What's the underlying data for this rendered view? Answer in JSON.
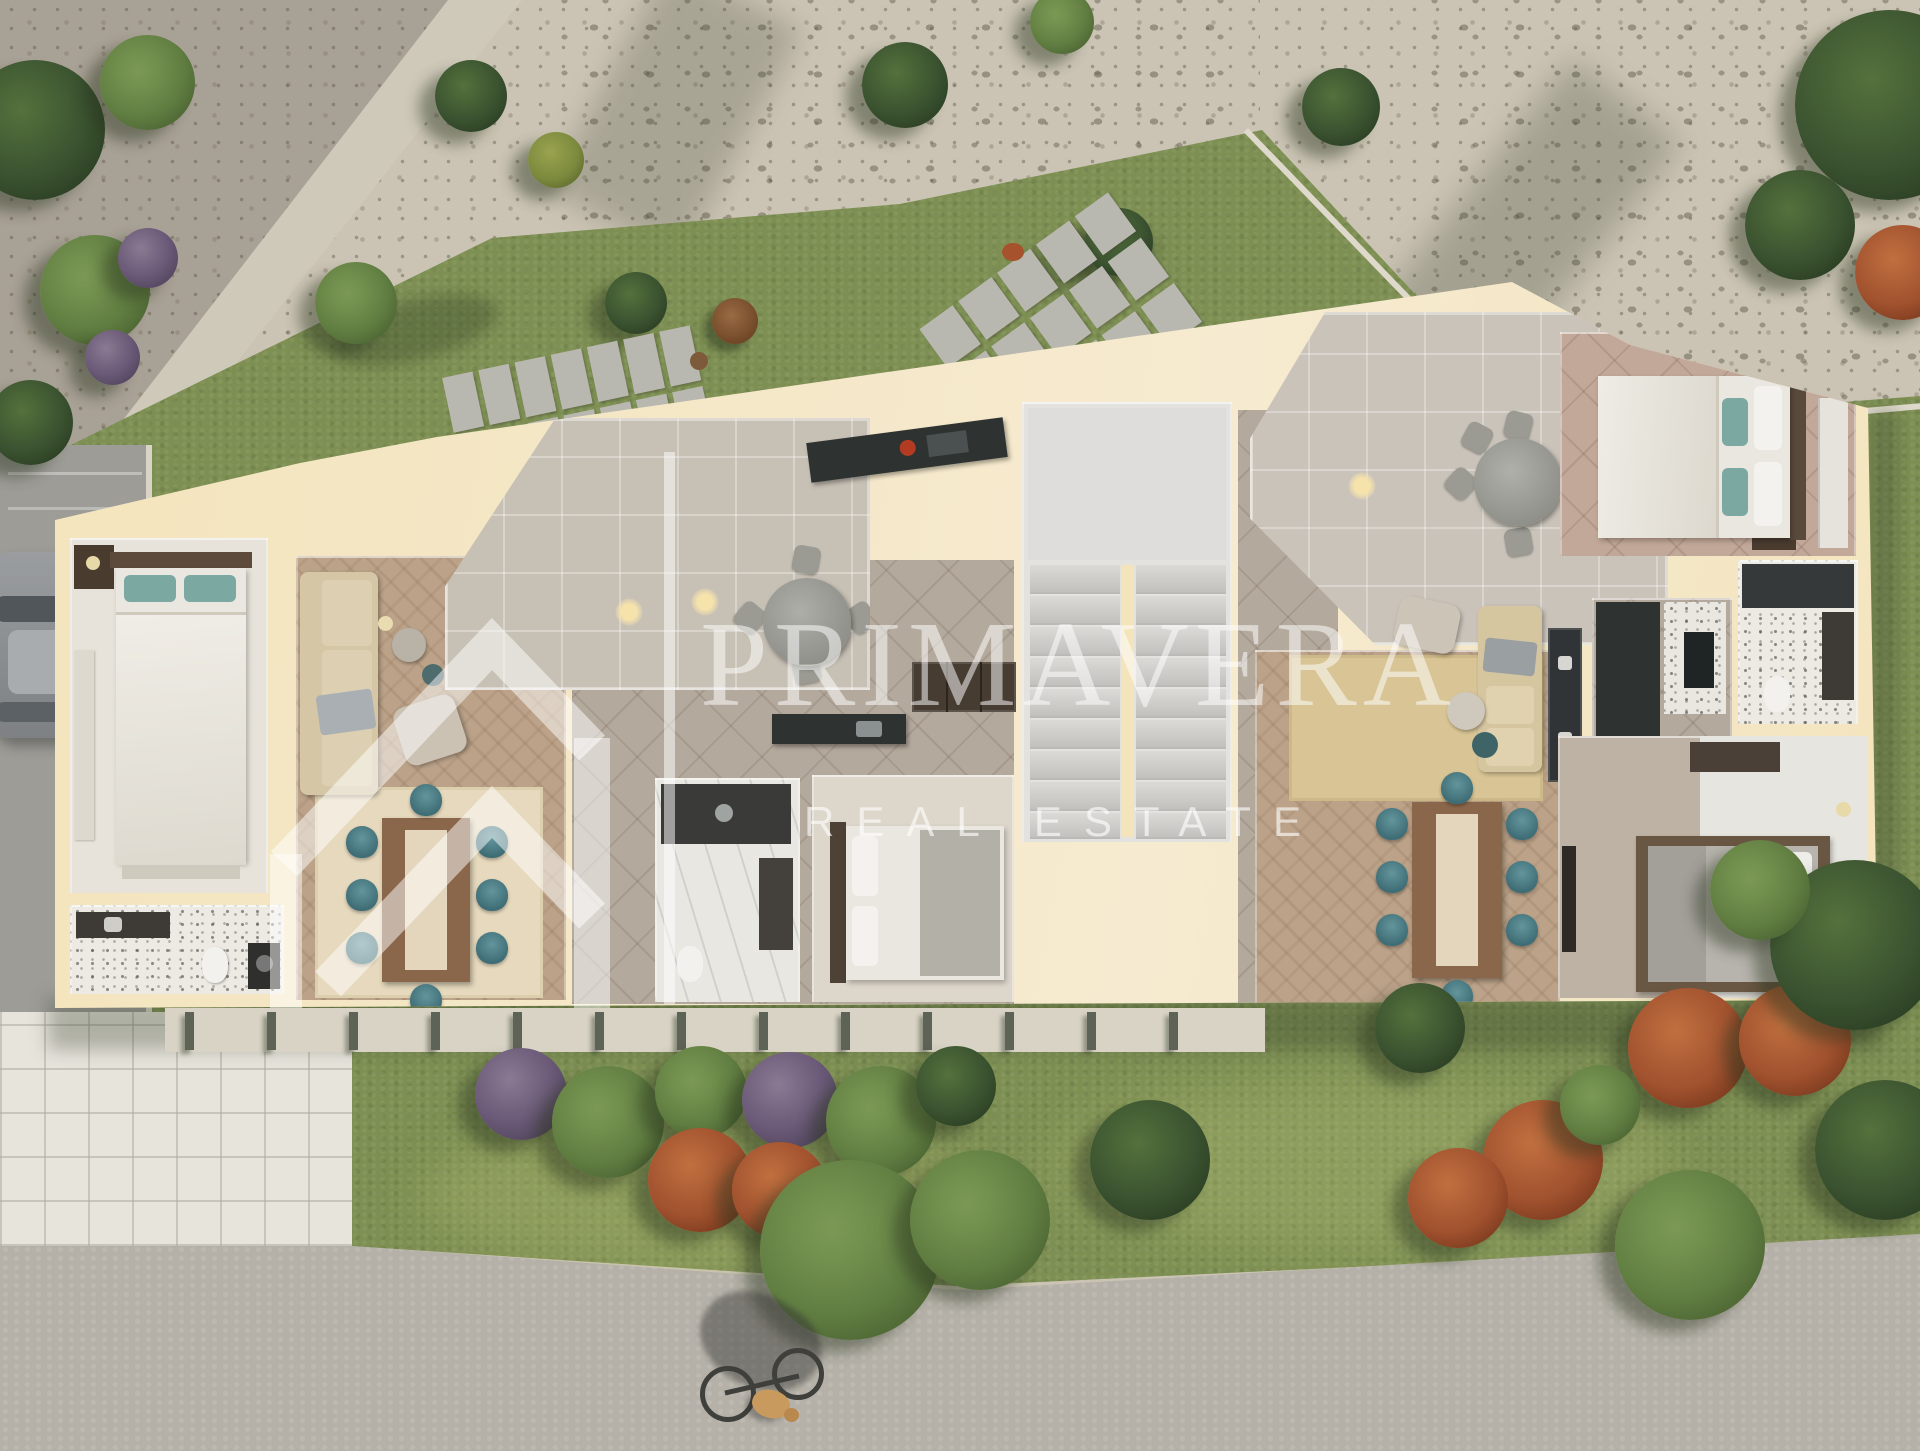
{
  "watermark": {
    "brand": "PRIMAVERA",
    "tagline": "REAL ESTATE",
    "logo": "house-chevron-icon"
  },
  "scene": {
    "kind": "photorealistic top-down 3D floor-plan rendering",
    "setting": "apartment building cross-section surrounded by gardens, gravel yard, driveway and footpath"
  },
  "palette": {
    "wall": "#f3e4bb",
    "grass": "#7d8f52",
    "grassLight": "#93a25f",
    "gravel": "#cbc4b4",
    "gravelDark": "#a8a195",
    "road": "#9d9c97",
    "concrete": "#b5b1a8",
    "tilewalk": "#e7e4dc",
    "wood": "#bba289",
    "tileFloor": "#b4a99d",
    "terraceFloor": "#c7c0b5",
    "marble": "#e9e7e1",
    "teal": "#4e7d85",
    "sofa": "#d5c7a6",
    "counterDark": "#2e3332",
    "bedWhite": "#eae7e0",
    "rustBush": "#a0512e",
    "treeDark": "#3a5230",
    "watermark": "rgba(255,255,255,0.52)"
  }
}
